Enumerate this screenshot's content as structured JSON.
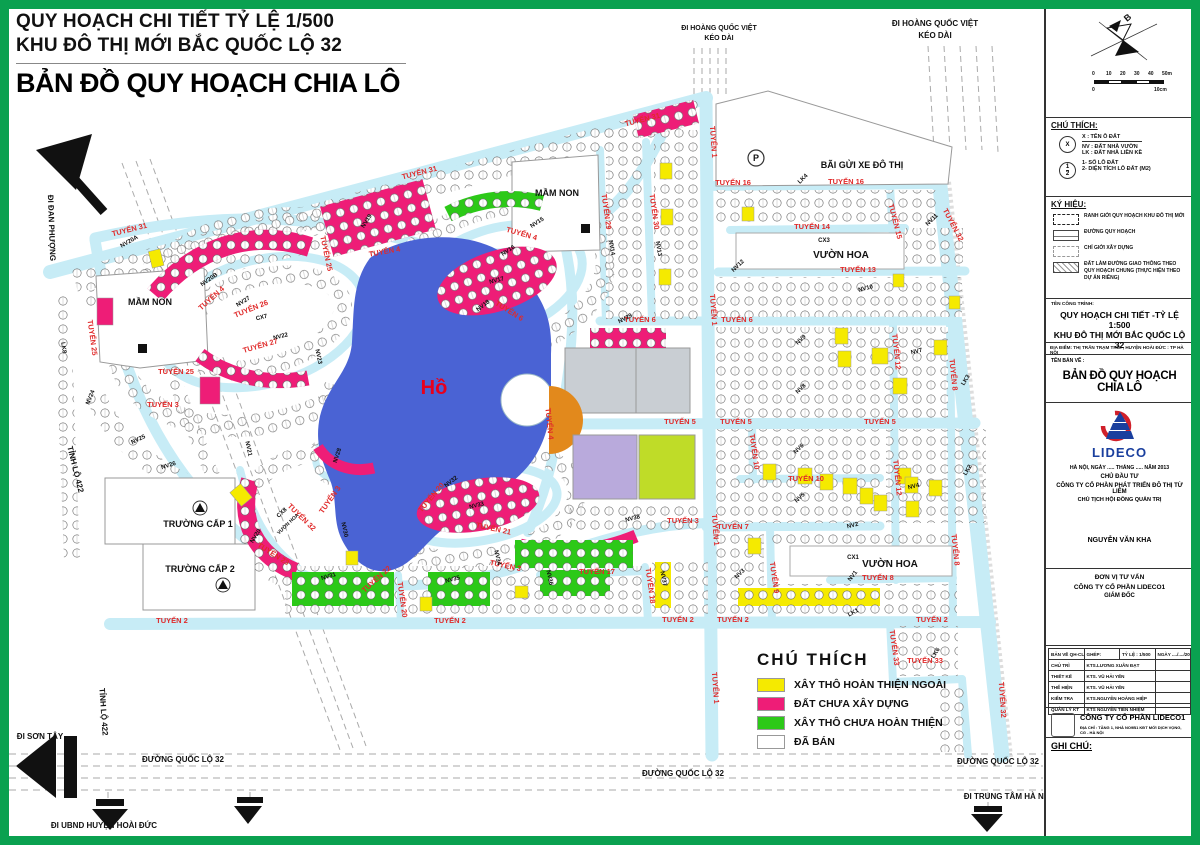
{
  "title_block": {
    "line1": "QUY HOẠCH CHI TIẾT TỶ LỆ 1/500",
    "line2": "KHU ĐÔ THỊ MỚI BẮC QUỐC LỘ 32",
    "line3": "BẢN ĐỒ QUY HOẠCH CHIA LÔ"
  },
  "legend": {
    "title": "CHÚ THÍCH",
    "items": [
      {
        "color": "#f5ea00",
        "label": "XÂY THÔ HOÀN THIỆN NGOÀI"
      },
      {
        "color": "#ee1d77",
        "label": "ĐẤT CHƯA XÂY DỰNG"
      },
      {
        "color": "#2cc918",
        "label": "XÂY THÔ CHƯA HOÀN THIỆN"
      },
      {
        "color": "#ffffff",
        "label": "ĐÃ BÁN"
      }
    ]
  },
  "colors": {
    "road": "#c7ecf6",
    "lake": "#4a63d4",
    "pink": "#ee1d77",
    "yellow": "#f5ea00",
    "green": "#2cc918",
    "orange": "#e2891c",
    "lavender": "#b9aadc",
    "chartreuse": "#bfdc28",
    "gray": "#c9ced3",
    "frame_green": "#0aa150",
    "road_label_red": "#e02a2a"
  },
  "map": {
    "lake_label": [
      [
        "Hồ",
        434,
        394,
        0,
        20
      ]
    ],
    "road_labels": [
      [
        "TUYẾN 31",
        130,
        232,
        -14
      ],
      [
        "TUYẾN 31",
        420,
        175,
        -14
      ],
      [
        "TUYẾN 31",
        643,
        122,
        -14
      ],
      [
        "TUYẾN 25",
        90,
        338,
        82
      ],
      [
        "TUYẾN 25",
        176,
        374,
        0
      ],
      [
        "TUYẾN 25",
        324,
        254,
        78
      ],
      [
        "TUYẾN 26",
        252,
        311,
        -22
      ],
      [
        "TUYẾN 27",
        261,
        348,
        -16
      ],
      [
        "TUYẾN 4",
        213,
        300,
        -42
      ],
      [
        "TUYẾN 4",
        385,
        254,
        -10
      ],
      [
        "TUYẾN 4",
        521,
        236,
        16
      ],
      [
        "TUYẾN 4",
        547,
        424,
        84
      ],
      [
        "TUYẾN 3",
        163,
        407,
        0
      ],
      [
        "TUYẾN 3",
        332,
        501,
        -55
      ],
      [
        "TUYẾN 3",
        505,
        568,
        12
      ],
      [
        "TUYẾN 3",
        683,
        523,
        0
      ],
      [
        "TUYẾN 6",
        508,
        313,
        32
      ],
      [
        "TUYẾN 6",
        640,
        322,
        0
      ],
      [
        "TUYẾN 6",
        737,
        322,
        0
      ],
      [
        "TUYẾN 5",
        680,
        424,
        0
      ],
      [
        "TUYẾN 5",
        736,
        424,
        0
      ],
      [
        "TUYẾN 5",
        880,
        424,
        0
      ],
      [
        "TUYẾN 1",
        711,
        142,
        86
      ],
      [
        "TUYẾN 1",
        711,
        310,
        86
      ],
      [
        "TUYẾN 1",
        713,
        530,
        86
      ],
      [
        "TUYẾN 1",
        713,
        688,
        86
      ],
      [
        "TUYẾN 16",
        733,
        185,
        0
      ],
      [
        "TUYẾN 16",
        846,
        184,
        0
      ],
      [
        "TUYẾN 14",
        812,
        229,
        0
      ],
      [
        "TUYẾN 13",
        858,
        272,
        0
      ],
      [
        "TUYẾN 15",
        893,
        222,
        76
      ],
      [
        "TUYẾN 29",
        604,
        212,
        82
      ],
      [
        "TUYẾN 30",
        652,
        212,
        82
      ],
      [
        "TUYẾN 32",
        951,
        226,
        62
      ],
      [
        "TUYẾN 32",
        1000,
        700,
        86
      ],
      [
        "TUYẾN 32",
        300,
        519,
        44
      ],
      [
        "TUYẾN 10",
        752,
        452,
        82
      ],
      [
        "TUYẾN 10",
        806,
        481,
        0
      ],
      [
        "TUYẾN 12",
        894,
        352,
        84
      ],
      [
        "TUYẾN 12",
        895,
        478,
        84
      ],
      [
        "TUYẾN 8",
        951,
        375,
        84
      ],
      [
        "TUYẾN 8",
        953,
        550,
        84
      ],
      [
        "TUYẾN 8",
        878,
        580,
        0
      ],
      [
        "TUYẾN 7",
        733,
        529,
        0
      ],
      [
        "TUYẾN 9",
        772,
        578,
        82
      ],
      [
        "TUYẾN 2",
        172,
        623,
        0
      ],
      [
        "TUYẾN 2",
        450,
        623,
        0
      ],
      [
        "TUYẾN 2",
        678,
        622,
        0
      ],
      [
        "TUYẾN 2",
        733,
        622,
        0
      ],
      [
        "TUYẾN 2",
        932,
        622,
        0
      ],
      [
        "TUYẾN 33",
        892,
        648,
        82
      ],
      [
        "TUYẾN 33",
        925,
        663,
        0
      ],
      [
        "TUYẾN 17",
        597,
        574,
        0
      ],
      [
        "TUYẾN 18",
        648,
        586,
        82
      ],
      [
        "TUYẾN 20",
        400,
        600,
        82
      ],
      [
        "TUYẾN 20",
        433,
        499,
        -50
      ],
      [
        "TUYẾN 21",
        493,
        531,
        12
      ],
      [
        "TUYẾN 22",
        378,
        581,
        -42
      ],
      [
        "TUYẾN 23",
        272,
        556,
        32
      ]
    ],
    "lot_labels": [
      [
        "LK8",
        62,
        348,
        82
      ],
      [
        "NV20A",
        130,
        243,
        -30
      ],
      [
        "NV20B",
        210,
        281,
        -35
      ],
      [
        "NV19",
        368,
        222,
        -58
      ],
      [
        "NV27",
        244,
        303,
        -32
      ],
      [
        "CX7",
        262,
        319,
        -14
      ],
      [
        "NV22",
        281,
        338,
        -14
      ],
      [
        "NV23",
        317,
        357,
        78
      ],
      [
        "NV21",
        247,
        449,
        78
      ],
      [
        "NV24",
        92,
        398,
        -68
      ],
      [
        "NV25",
        139,
        441,
        -26
      ],
      [
        "NV26",
        169,
        467,
        -18
      ],
      [
        "NV20",
        257,
        537,
        -58
      ],
      [
        "CX8",
        283,
        514,
        -44
      ],
      [
        "NV28",
        339,
        456,
        -72
      ],
      [
        "NV32",
        452,
        483,
        -38
      ],
      [
        "NV29",
        626,
        320,
        -28
      ],
      [
        "NV14",
        610,
        248,
        80
      ],
      [
        "NV13",
        657,
        249,
        80
      ],
      [
        "NV15",
        538,
        224,
        -33
      ],
      [
        "NV16",
        509,
        252,
        -33
      ],
      [
        "NV17",
        497,
        282,
        -14
      ],
      [
        "NV18",
        484,
        307,
        -38
      ],
      [
        "NV12",
        739,
        267,
        -44
      ],
      [
        "NV11",
        933,
        221,
        -44
      ],
      [
        "NV10",
        866,
        290,
        -14
      ],
      [
        "NV9",
        802,
        341,
        -44
      ],
      [
        "NV8",
        802,
        390,
        -44
      ],
      [
        "NV7",
        917,
        353,
        -14
      ],
      [
        "LK4",
        804,
        180,
        -44
      ],
      [
        "LK3",
        967,
        381,
        -58
      ],
      [
        "NV6",
        800,
        450,
        -44
      ],
      [
        "NV5",
        801,
        499,
        -44
      ],
      [
        "NV4",
        914,
        488,
        -14
      ],
      [
        "LK2",
        969,
        471,
        -58
      ],
      [
        "NV3",
        741,
        575,
        -44
      ],
      [
        "NV2",
        853,
        527,
        -14
      ],
      [
        "CX1",
        853,
        559,
        0
      ],
      [
        "NV1",
        854,
        577,
        -52
      ],
      [
        "LK1",
        854,
        614,
        -28
      ],
      [
        "LK6",
        937,
        654,
        -58
      ],
      [
        "NV38",
        633,
        520,
        -14
      ],
      [
        "NV30",
        343,
        530,
        78
      ],
      [
        "NV31",
        329,
        578,
        -16
      ],
      [
        "NV33",
        477,
        507,
        -14
      ],
      [
        "NV34",
        496,
        558,
        78
      ],
      [
        "NV35",
        453,
        581,
        -14
      ],
      [
        "NV36",
        548,
        578,
        78
      ],
      [
        "NV37",
        662,
        579,
        78
      ]
    ],
    "area_labels": [
      [
        "MẦM NON",
        150,
        305,
        0,
        9
      ],
      [
        "MẦM NON",
        557,
        196,
        0,
        9
      ],
      [
        "BÃI GỬI XE ĐÔ THỊ",
        862,
        168,
        0,
        9
      ],
      [
        "P",
        756,
        161,
        0,
        9
      ],
      [
        "VƯỜN HOA",
        841,
        258,
        0,
        10
      ],
      [
        "CX3",
        824,
        242,
        0,
        6
      ],
      [
        "VƯỜN HOA",
        890,
        567,
        0,
        10
      ],
      [
        "VƯỜN HOA",
        289,
        525,
        -44,
        5
      ],
      [
        "TRƯỜNG CẤP 1",
        198,
        527,
        0,
        9
      ],
      [
        "TRƯỜNG CẤP 2",
        200,
        572,
        0,
        9
      ]
    ],
    "edge_labels": [
      [
        "ĐI HOÀNG QUỐC VIỆT",
        719,
        30,
        0,
        7
      ],
      [
        "KÉO DÀI",
        719,
        40,
        0,
        7
      ],
      [
        "ĐI HOÀNG QUỐC VIỆT",
        935,
        26,
        0,
        8
      ],
      [
        "KÉO DÀI",
        935,
        38,
        0,
        8
      ],
      [
        "ĐI ĐAN PHƯỢNG",
        49,
        228,
        88,
        8
      ],
      [
        "TỈNH LỘ 422",
        73,
        470,
        76,
        8
      ],
      [
        "TỈNH LỘ 422",
        101,
        712,
        86,
        8
      ],
      [
        "ĐI SƠN TÂY",
        40,
        739,
        0,
        8
      ],
      [
        "ĐƯỜNG QUỐC LỘ 32",
        183,
        762,
        0,
        8
      ],
      [
        "ĐƯỜNG QUỐC LỘ 32",
        683,
        776,
        0,
        8
      ],
      [
        "ĐƯỜNG QUỐC LỘ 32",
        998,
        764,
        0,
        8
      ],
      [
        "ĐI UBND HUYỆN HOÀI ĐỨC",
        104,
        828,
        0,
        8
      ],
      [
        "ĐI TRUNG TÂM HÀ NỘI",
        1008,
        799,
        0,
        8
      ]
    ]
  },
  "sidebar": {
    "compass_label": "B",
    "scale": {
      "ticks": [
        "0",
        "10",
        "20",
        "30",
        "40",
        "50m"
      ],
      "sub_left": "0",
      "sub_right": "10cm"
    },
    "chu_thich": {
      "title": "CHÚ THÍCH:",
      "x_symbol": "X",
      "lines": [
        "X : TÊN Ô ĐẤT",
        "NV : ĐẤT NHÀ VƯỜN",
        "LK : ĐẤT NHÀ LIỀN KỀ"
      ],
      "frac_top": "1",
      "frac_bottom": "2",
      "frac_lines": [
        "1- SỐ LÔ ĐẤT",
        "2- DIỆN TÍCH LÔ ĐẤT (M2)"
      ]
    },
    "ky_hieu": {
      "title": "KÝ HIỆU:",
      "items": [
        {
          "symbol": "boundary",
          "label": "RANH GIỚI QUY HOẠCH KHU ĐÔ THỊ MỚI"
        },
        {
          "symbol": "road",
          "label": "ĐƯỜNG QUY HOẠCH"
        },
        {
          "symbol": "dashed",
          "label": "CHỈ GIỚI XÂY DỰNG"
        },
        {
          "symbol": "hatch",
          "label": "ĐẤT LÀM ĐƯỜNG GIAO THÔNG THEO QUY HOẠCH CHUNG (THỰC HIỆN THEO DỰ ÁN RIÊNG)"
        }
      ]
    },
    "ten_cong_trinh_label": "TÊN CÔNG TRÌNH:",
    "project_title_line1": "QUY HOẠCH CHI TIẾT -TỶ LỆ 1:500",
    "project_title_line2": "KHU ĐÔ THỊ MỚI BẮC QUỐC LỘ 32",
    "dia_diem": "ĐỊA ĐIỂM: THỊ TRẤN TRẠM TRÔI , HUYỆN HOÀI ĐỨC : TP HÀ NỘI",
    "ten_ban_ve_label": "TÊN BẢN VẼ :",
    "drawing_title": "BẢN ĐỒ QUY HOẠCH CHIA LÔ",
    "logo_text": "LIDECO",
    "date_line": "HÀ NỘI, NGÀY ..... THÁNG ..... NĂM 2013",
    "chu_dau_tu_label": "CHỦ ĐẦU TƯ",
    "investor": "CÔNG TY CỔ PHẦN PHÁT TRIỂN ĐÔ THỊ TỪ LIÊM",
    "chairman_title": "CHỦ TỊCH HỘI ĐỒNG QUẢN TRỊ",
    "chairman_name": "NGUYỄN VĂN KHA",
    "consultant_label": "ĐƠN VỊ TƯ VẤN",
    "consultant": "CÔNG TY CỔ PHẦN LIDECO1",
    "director_title": "GIÁM ĐỐC",
    "table": {
      "row0": [
        "BẢN VẼ QH-CL",
        "GHÉP:",
        "TỶ LỆ : 1/500",
        "NGÀY ..../..../2013"
      ],
      "rows": [
        [
          "CHỦ TRÌ",
          "KTS.LƯƠNG XUÂN ĐẠT"
        ],
        [
          "THIẾT KẾ",
          "KTS. VŨ HẢI YẾN"
        ],
        [
          "THỂ HIỆN",
          "KTS. VŨ HẢI YẾN"
        ],
        [
          "KIỂM TRA",
          "KTS.NGUYỄN HOÀNG HIỆP"
        ],
        [
          "QUẢN LÝ KT",
          "KTS NGUYỄN TIẾN NHIỆM"
        ]
      ]
    },
    "company_box": {
      "name": "CÔNG TY CỔ PHẦN LIDECO1",
      "address": "ĐỊA CHỈ : TẦNG 1, NHÀ NO9B1 KĐT MỚI DỊCH VỌNG, CG - HÀ NỘI"
    },
    "ghi_chu_label": "GHI CHÚ:"
  }
}
